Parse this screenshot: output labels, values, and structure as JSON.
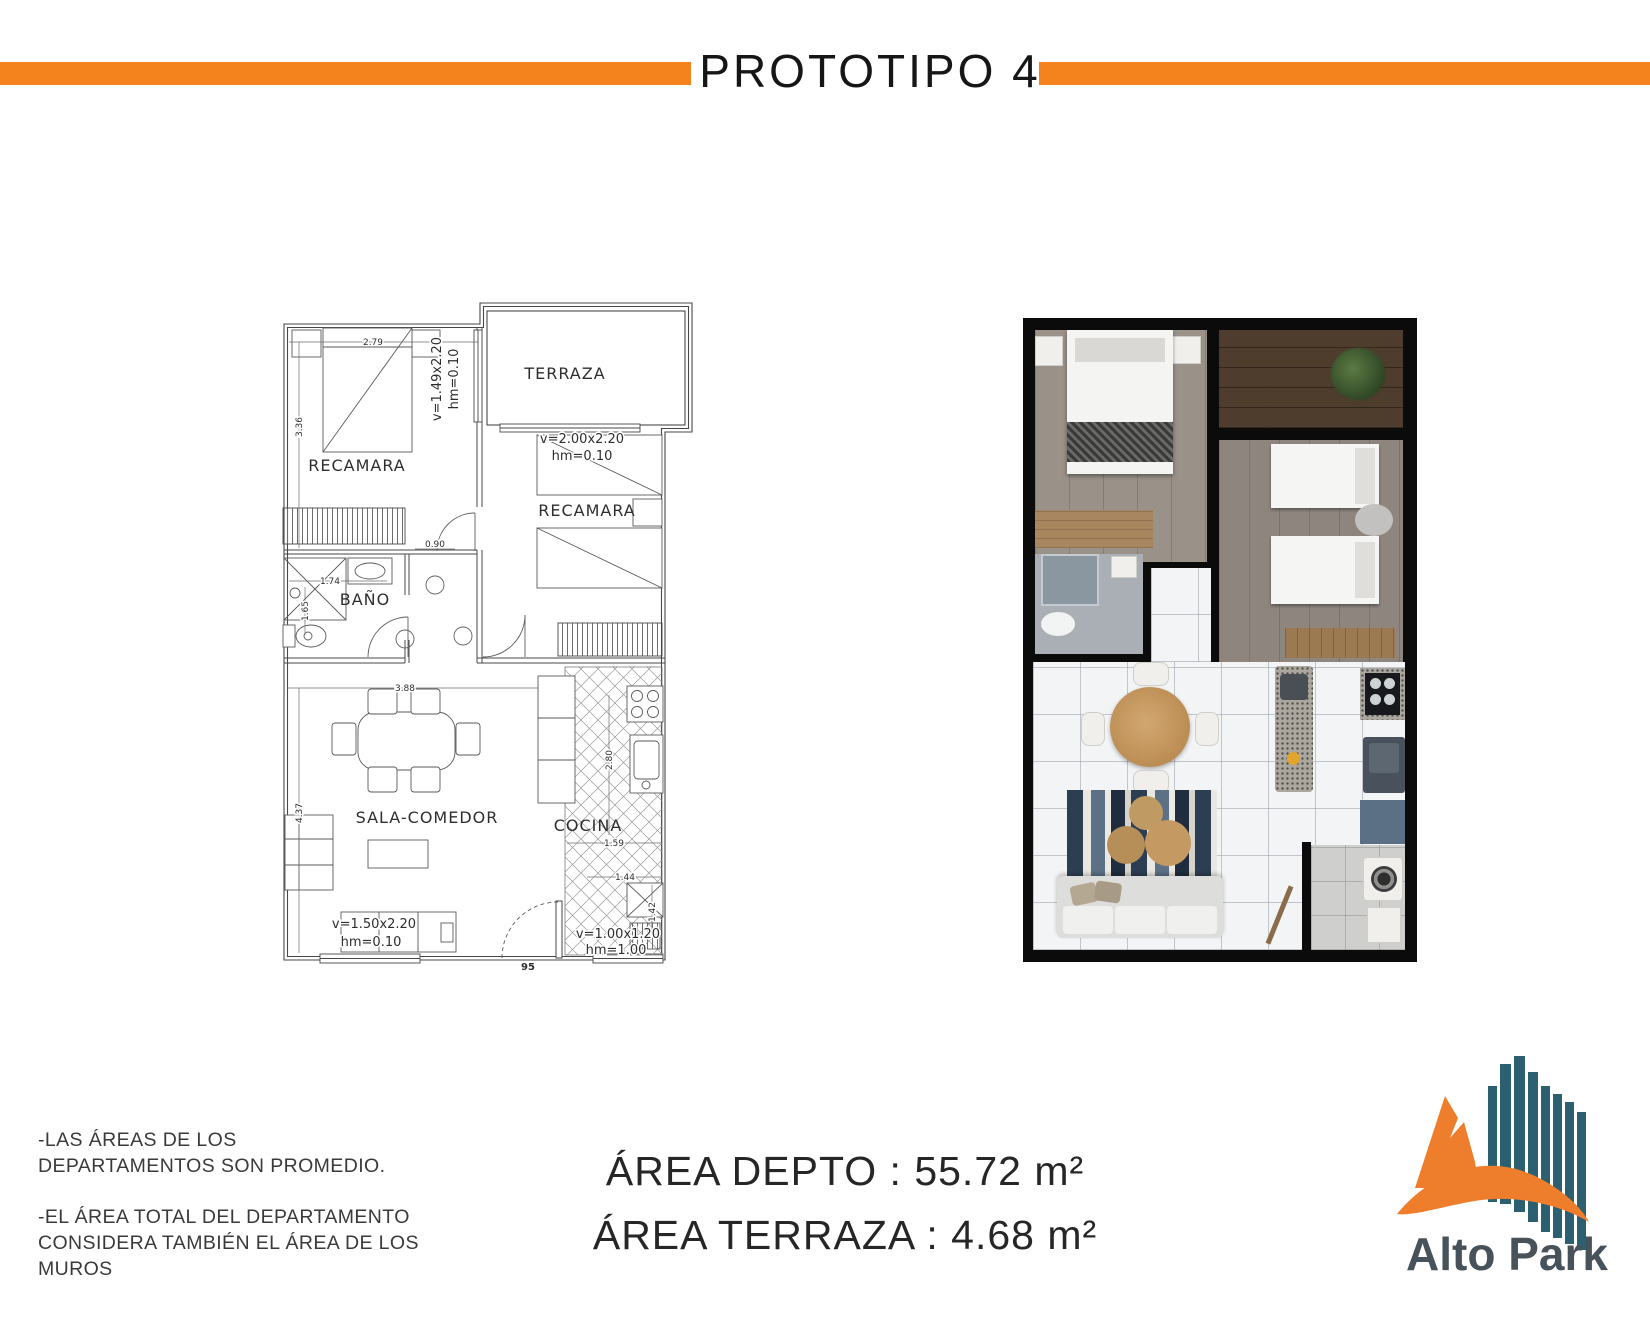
{
  "title": "PROTOTIPO 4",
  "theme": {
    "accent_orange": "#F5831D",
    "logo_teal": "#2C5F6F",
    "logo_orange": "#EE7E2B",
    "logo_text_color": "#47525B"
  },
  "plan": {
    "rooms": {
      "bedroom1": "RECAMARA",
      "terrace": "TERRAZA",
      "bedroom2": "RECAMARA",
      "bathroom": "BAÑO",
      "living": "SALA-COMEDOR",
      "kitchen": "COCINA"
    },
    "dims": {
      "bed1_w": "2.79",
      "bed1_h": "3.36",
      "win1_a": "v=1.49x2.20",
      "win1_b": "hm=0.10",
      "win2_a": "v=2.00x2.20",
      "win2_b": "hm=0.10",
      "hall_door": "0.90",
      "bath_w": "1.74",
      "bath_h": "1.65",
      "living_w": "3.88",
      "living_h": "4.37",
      "kitchen_h": "2.80",
      "kitchen_w1": "1.59",
      "kitchen_w2": "1.44",
      "kitchen_w3": "1.42",
      "win3_a": "v=1.50x2.20",
      "win3_b": "hm=0.10",
      "entry_door": "95",
      "win4_a": "v=1.00x1.20",
      "win4_b": "hm=1.00"
    }
  },
  "notes": {
    "p1_l1": "-LAS ÁREAS DE LOS",
    "p1_l2": "DEPARTAMENTOS SON PROMEDIO.",
    "p2_l1": "-EL ÁREA TOTAL DEL DEPARTAMENTO",
    "p2_l2": "CONSIDERA TAMBIÉN EL ÁREA DE LOS",
    "p2_l3": "MUROS"
  },
  "areas": {
    "depto": "ÁREA DEPTO : 55.72 m²",
    "terraza": "ÁREA TERRAZA : 4.68 m²"
  },
  "logo": {
    "name": "Alto Park"
  }
}
